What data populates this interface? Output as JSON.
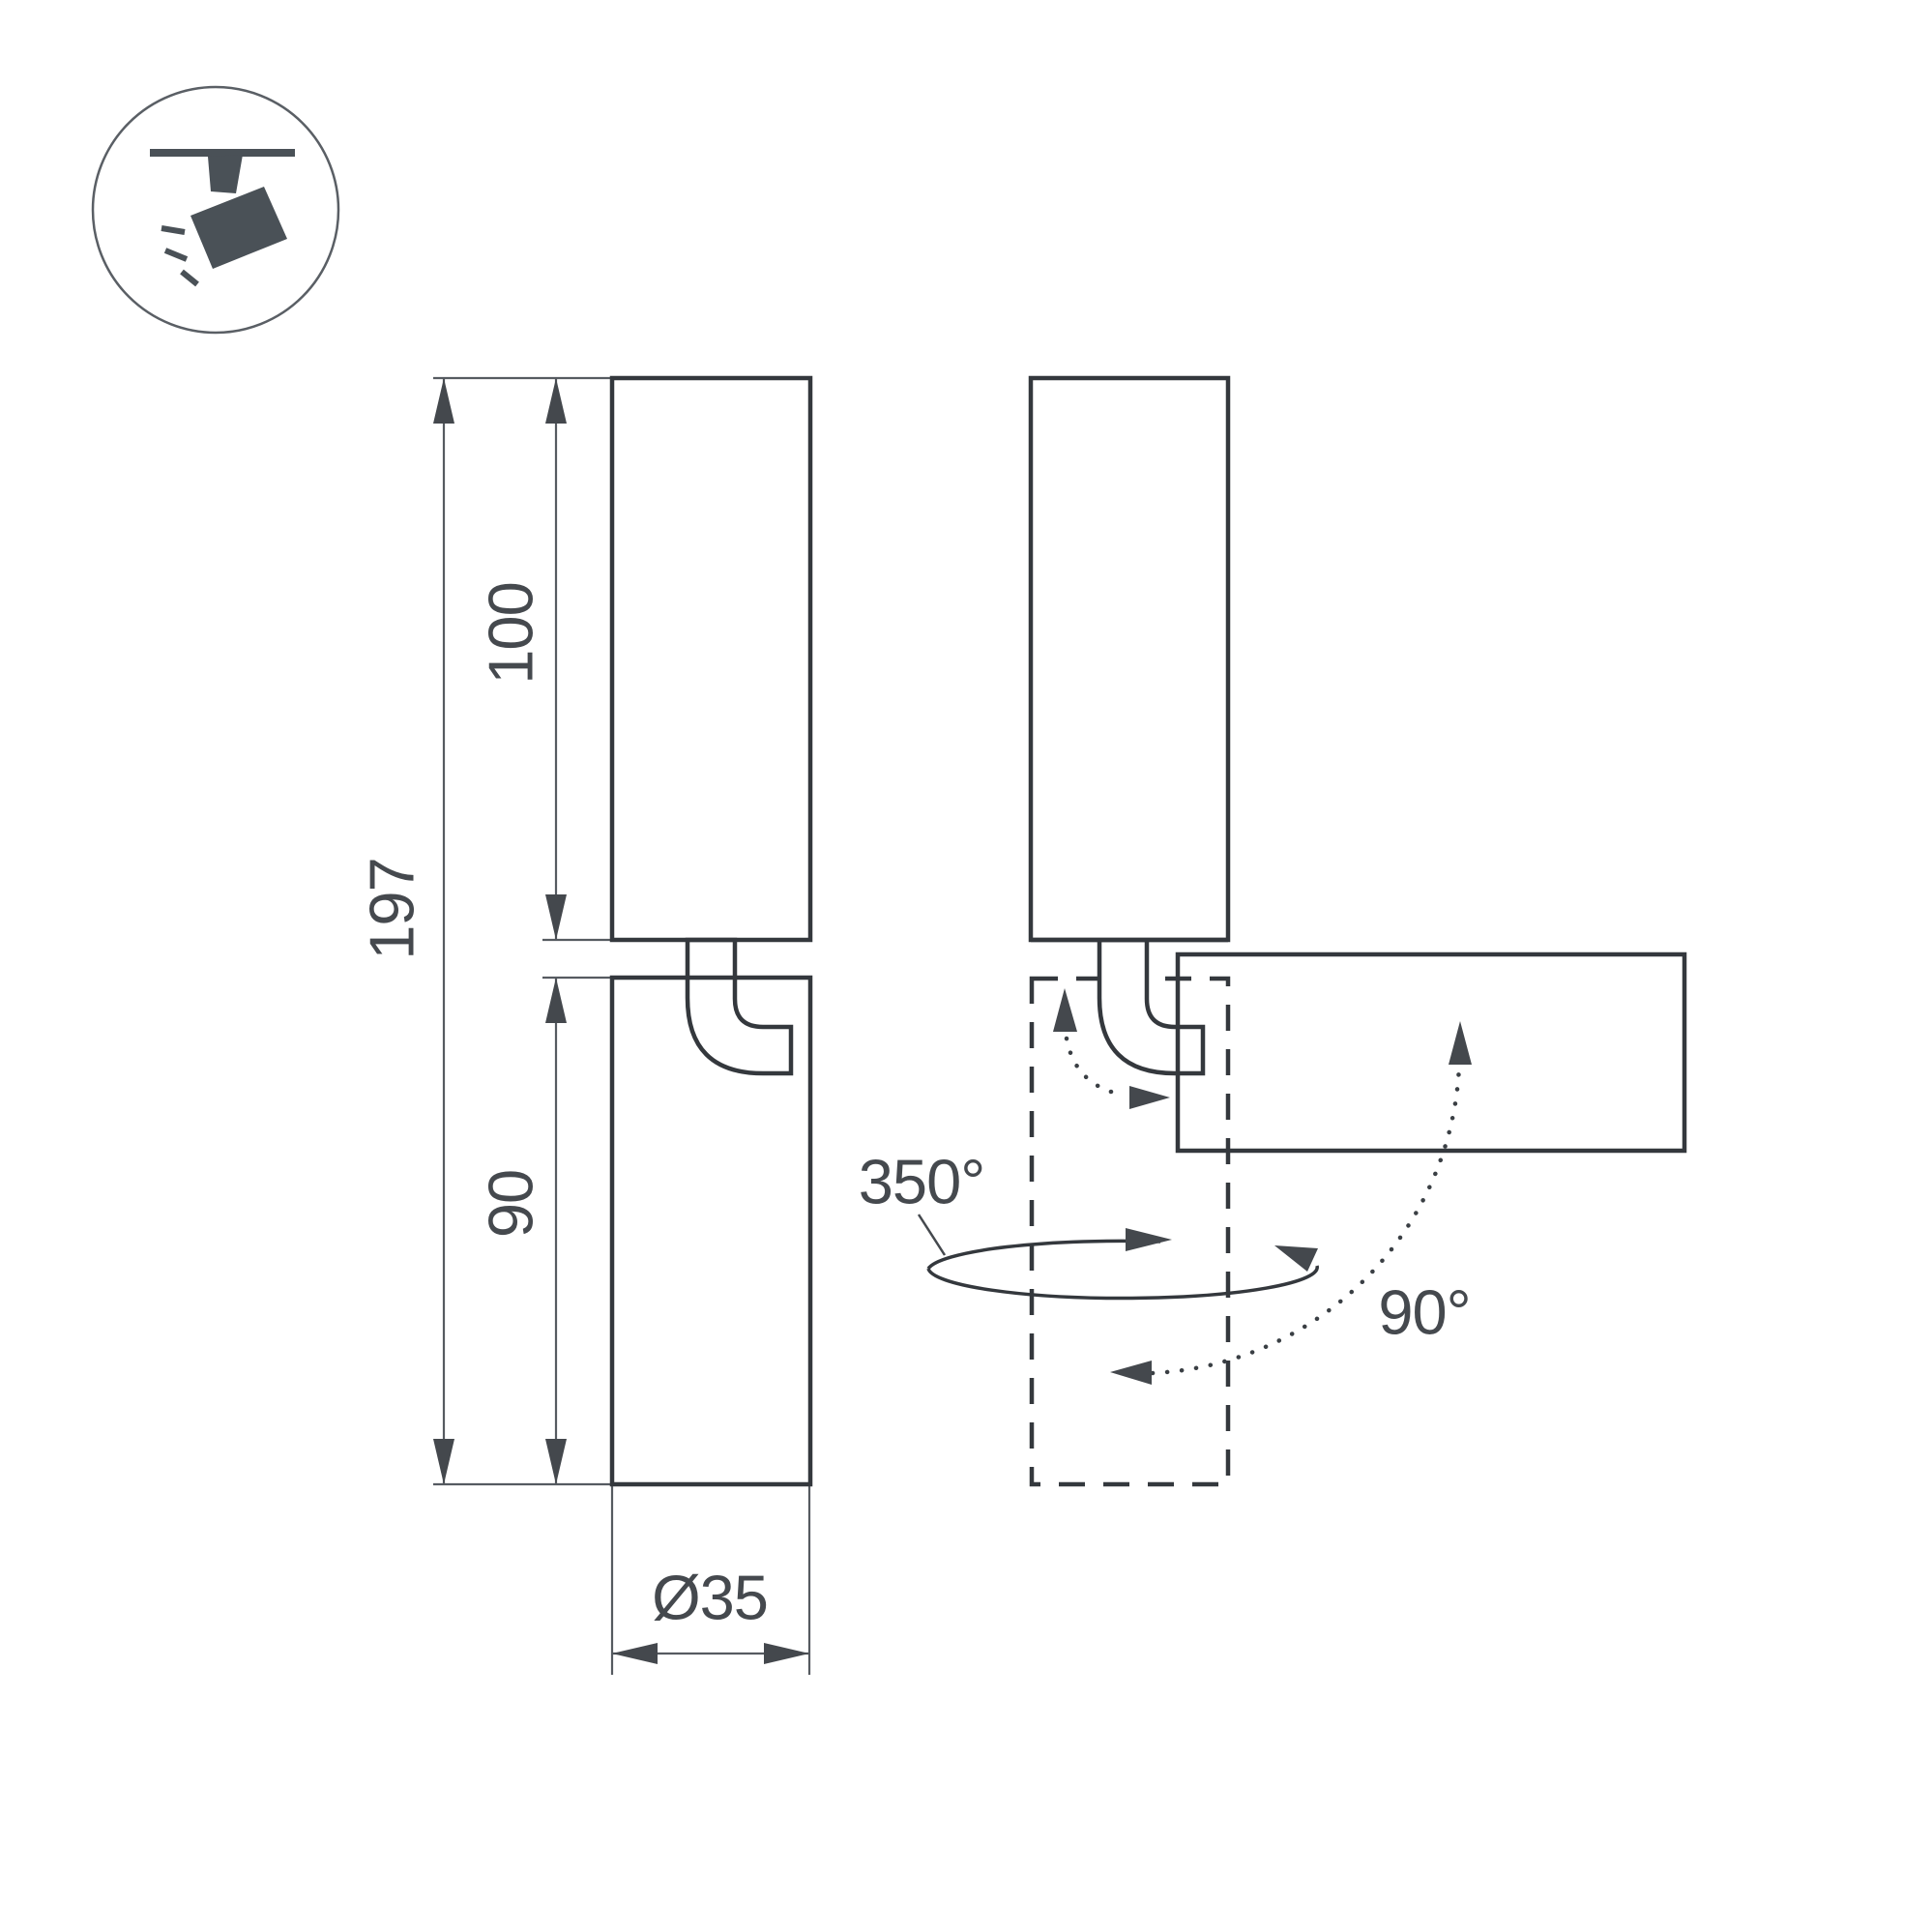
{
  "drawing": {
    "title": "spotlight-dimension-drawing",
    "dims": {
      "total": "197",
      "upper": "100",
      "lower": "90",
      "diameter": "Ø35"
    },
    "angles": {
      "pan": "350°",
      "tilt": "90°"
    },
    "colors": {
      "outline": "#34383d",
      "dimension": "#565b61",
      "text": "#45494e",
      "icon": "#4a5157",
      "background": "#ffffff"
    }
  },
  "icon": {
    "name": "ceiling-track-spotlight"
  }
}
